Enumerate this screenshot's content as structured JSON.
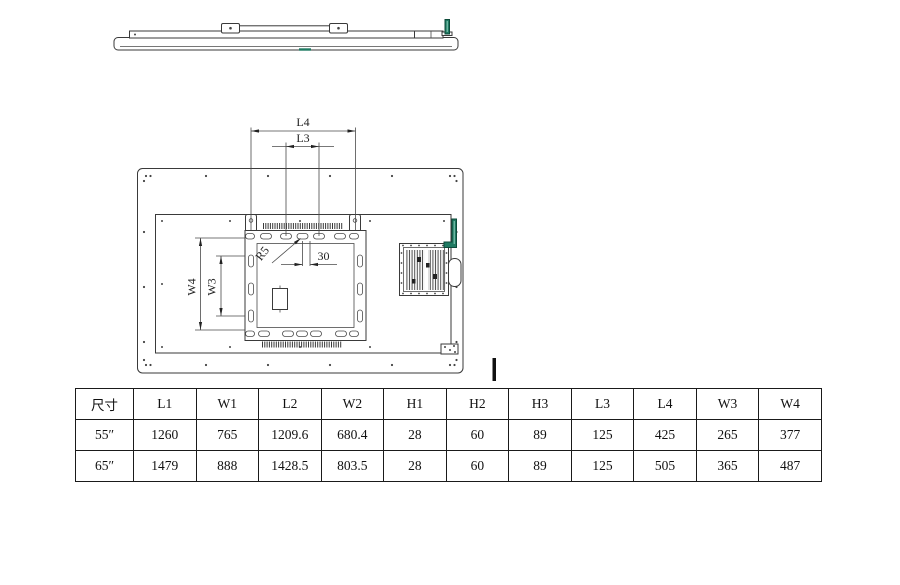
{
  "drawing": {
    "dim_labels": {
      "l4": "L4",
      "l3": "L3",
      "w4": "W4",
      "w3": "W3",
      "r5": "R5",
      "d30": "30"
    },
    "colors": {
      "line": "#3a3a3a",
      "green": "#1f7a62"
    }
  },
  "table": {
    "headers": [
      "尺寸",
      "L1",
      "W1",
      "L2",
      "W2",
      "H1",
      "H2",
      "H3",
      "L3",
      "L4",
      "W3",
      "W4"
    ],
    "rows": [
      [
        "55″",
        "1260",
        "765",
        "1209.6",
        "680.4",
        "28",
        "60",
        "89",
        "125",
        "425",
        "265",
        "377"
      ],
      [
        "65″",
        "1479",
        "888",
        "1428.5",
        "803.5",
        "28",
        "60",
        "89",
        "125",
        "505",
        "365",
        "487"
      ]
    ]
  }
}
